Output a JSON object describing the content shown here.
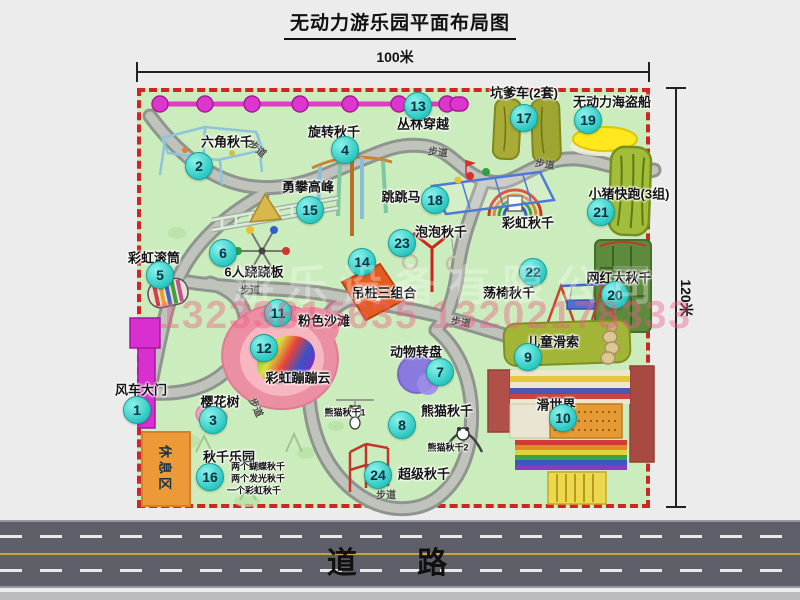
{
  "title": "无动力游乐园平面布局图",
  "dimension_labels": {
    "width": "100米",
    "height": "120米"
  },
  "road": {
    "label": "道  路"
  },
  "watermark": {
    "company": "游乐设备有限公司",
    "phone": "13233815635 13202178333"
  },
  "path_label": "步道",
  "rest_area": "休息区",
  "attractions": [
    {
      "num": "1",
      "name": "风车大门"
    },
    {
      "num": "2",
      "name": "六角秋千"
    },
    {
      "num": "3",
      "name": "樱花树"
    },
    {
      "num": "4",
      "name": "旋转秋千"
    },
    {
      "num": "5",
      "name": "彩虹滚筒"
    },
    {
      "num": "6",
      "name": "6人跷跷板"
    },
    {
      "num": "7",
      "name": "动物转盘"
    },
    {
      "num": "8",
      "name": "熊猫秋千"
    },
    {
      "num": "9",
      "name": "儿童滑索"
    },
    {
      "num": "10",
      "name": "滑世界"
    },
    {
      "num": "11",
      "name": "粉色沙滩"
    },
    {
      "num": "12",
      "name": "彩虹蹦蹦云"
    },
    {
      "num": "13",
      "name": "丛林穿越"
    },
    {
      "num": "14",
      "name": "吊桩三组合"
    },
    {
      "num": "15",
      "name": "勇攀高峰"
    },
    {
      "num": "16",
      "name": "秋千乐园"
    },
    {
      "num": "17",
      "name": "坑爹车(2套)"
    },
    {
      "num": "18",
      "name": "跳跳马"
    },
    {
      "num": "19",
      "name": "无动力海盗船"
    },
    {
      "num": "20",
      "name": "网红大秋千"
    },
    {
      "num": "21",
      "name": "小猪快跑(3组)"
    },
    {
      "num": "22",
      "name": "荡椅秋千"
    },
    {
      "num": "23",
      "name": "泡泡秋千"
    },
    {
      "num": "24",
      "name": "超级秋千"
    }
  ],
  "standalone_labels": {
    "rainbow_swing": "彩虹秋千",
    "panda_swing_1": "熊猫秋千1",
    "panda_swing_2": "熊猫秋千2"
  },
  "swing_park_notes": [
    "两个蝴蝶秋千",
    "两个发光秋千",
    "一个彩虹秋千"
  ]
}
